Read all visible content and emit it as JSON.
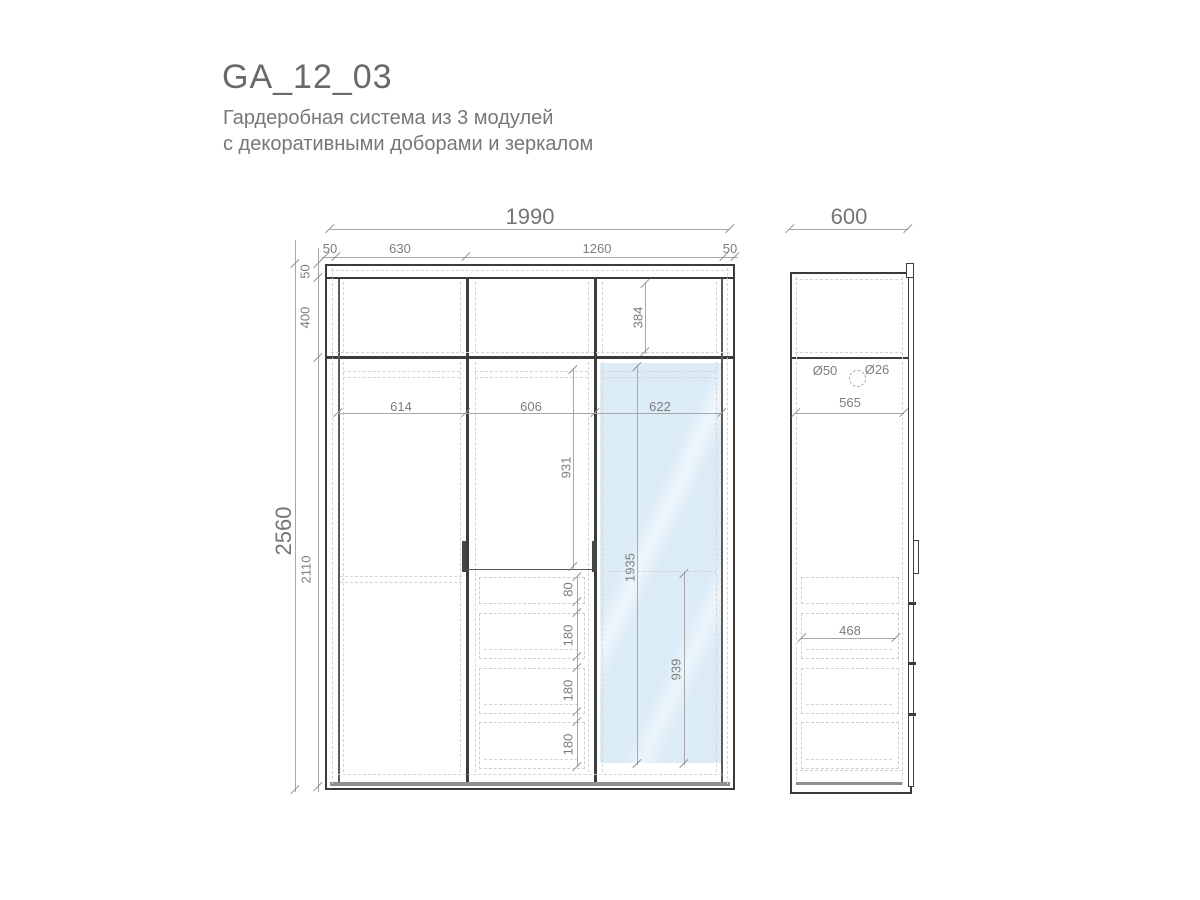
{
  "header": {
    "title": "GA_12_03",
    "subtitle_line1": "Гардеробная система из 3 модулей",
    "subtitle_line2": "с декоративными доборами и зеркалом"
  },
  "front_view": {
    "overall_width": "1990",
    "width_segments": [
      "50",
      "630",
      "1260",
      "50"
    ],
    "overall_height": "2560",
    "height_segments": [
      "50",
      "400",
      "2110"
    ],
    "module_inner_widths": [
      "614",
      "606",
      "622"
    ],
    "mezzanine_inner_height": "384",
    "middle_upper_height": "931",
    "drawer_heights": [
      "80",
      "180",
      "180",
      "180"
    ],
    "mirror_height": "1935",
    "mirror_lower_height": "939"
  },
  "side_view": {
    "depth": "600",
    "rod_diameter_1": "Ø50",
    "rod_diameter_2": "Ø26",
    "inner_depth": "565",
    "drawer_depth": "468"
  },
  "colors": {
    "mirror_fill": "#dcecf7",
    "line_dark": "#3b3b3b",
    "dimension_gray": "#8f8f8f"
  }
}
